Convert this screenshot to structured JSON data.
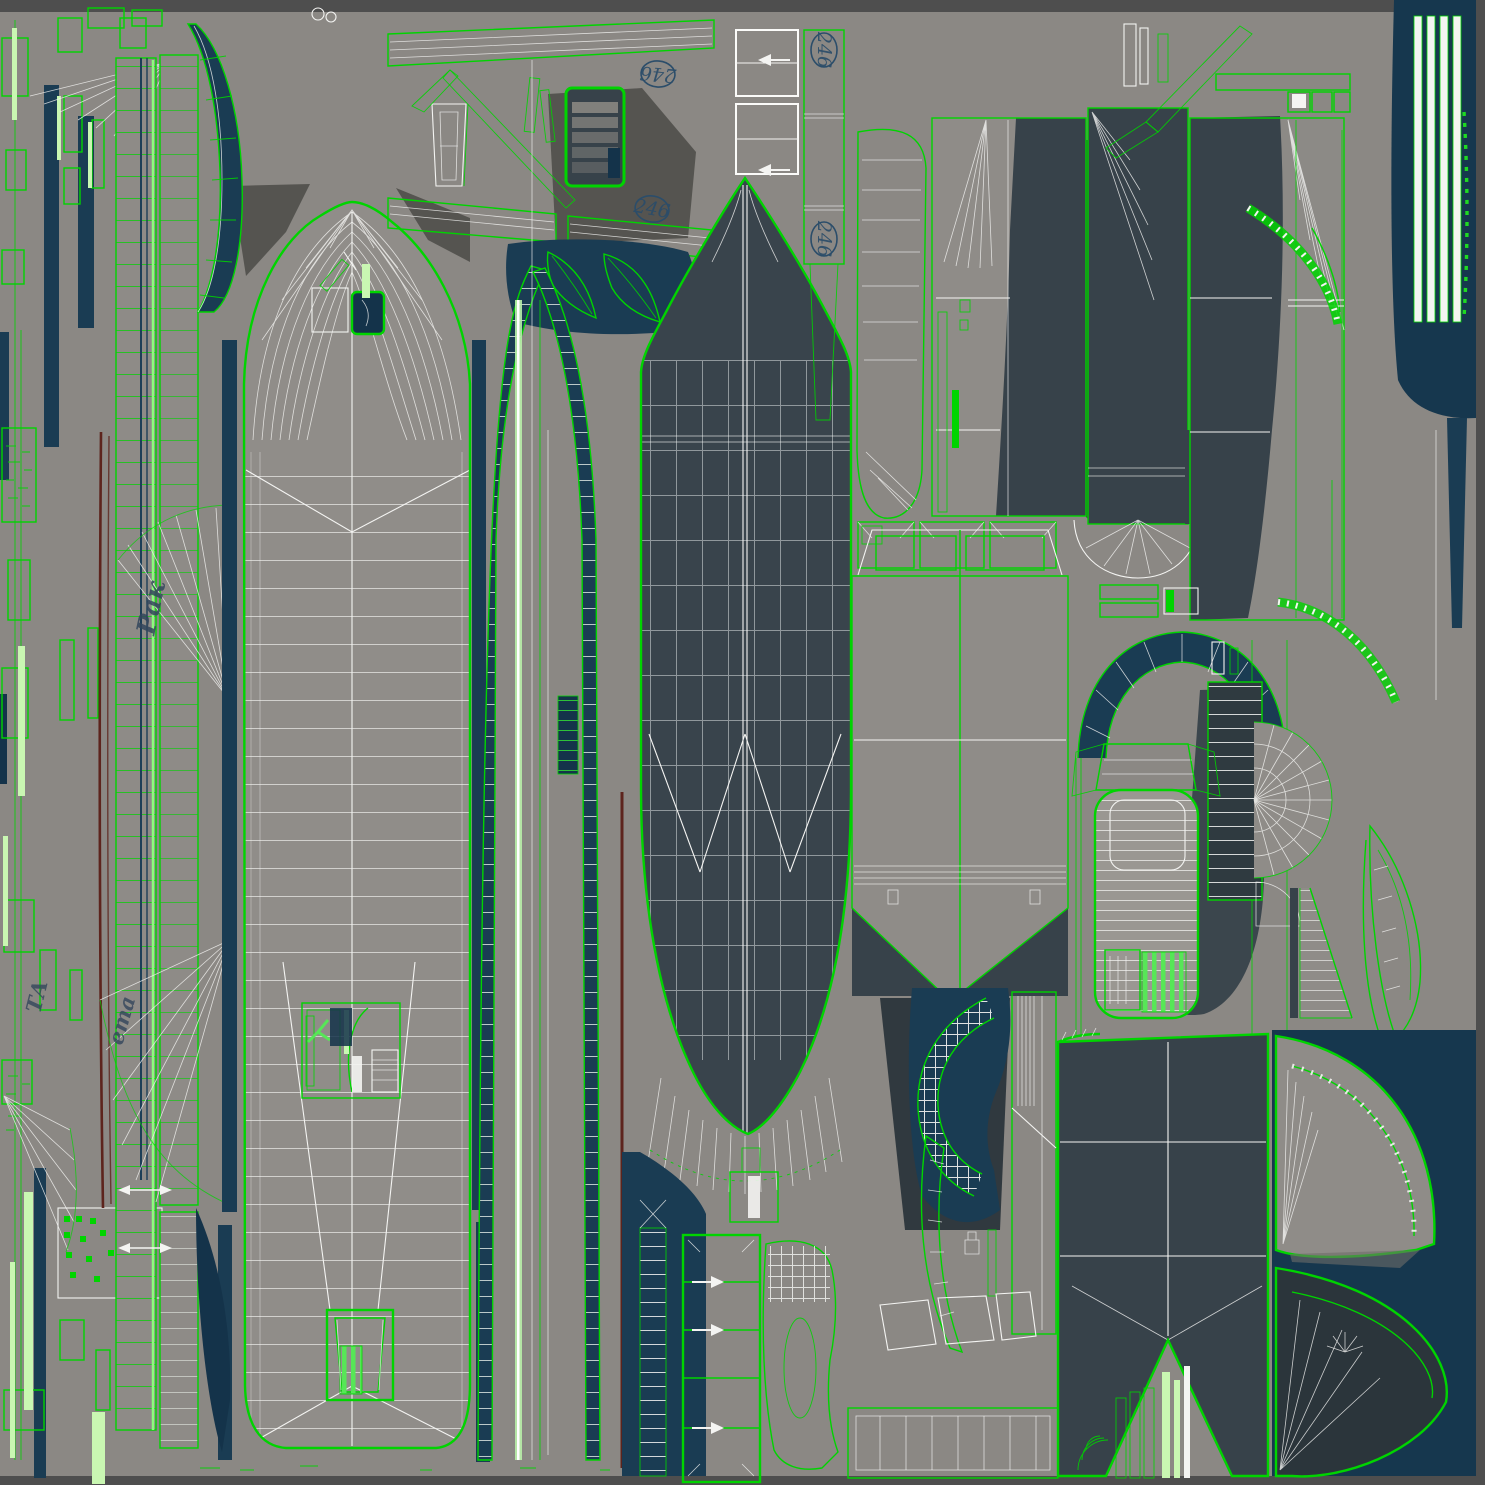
{
  "meta": {
    "type": "uv-texture-atlas",
    "subject": "ship 3D model wireframe UV unwrap texture"
  },
  "palette": {
    "background": "#8b8884",
    "frame": "#4e4e4e",
    "wireframe_white": "#f4f4f2",
    "island_border_green": "#00d400",
    "panel_charcoal": "#37424a",
    "panel_navy": "#1a3c53",
    "accent_bright_green": "#c9f7b2",
    "boot_stripe_red": "#5d241d",
    "stamp_ink_blue": "#2b4d6a"
  },
  "stamps": [
    {
      "label": "246",
      "x": 658,
      "y": 74,
      "rotation": 185
    },
    {
      "label": "246",
      "x": 652,
      "y": 209,
      "rotation": 10
    },
    {
      "label": "246",
      "x": 824,
      "y": 50,
      "rotation": 90
    },
    {
      "label": "246",
      "x": 824,
      "y": 239,
      "rotation": 90
    }
  ],
  "hull_markings": [
    {
      "text": "Рак",
      "x": 154,
      "y": 636,
      "rotation": -78
    },
    {
      "text": "ета",
      "x": 122,
      "y": 1046,
      "rotation": -74
    },
    {
      "text": "ТА",
      "x": 40,
      "y": 1014,
      "rotation": -76
    }
  ]
}
